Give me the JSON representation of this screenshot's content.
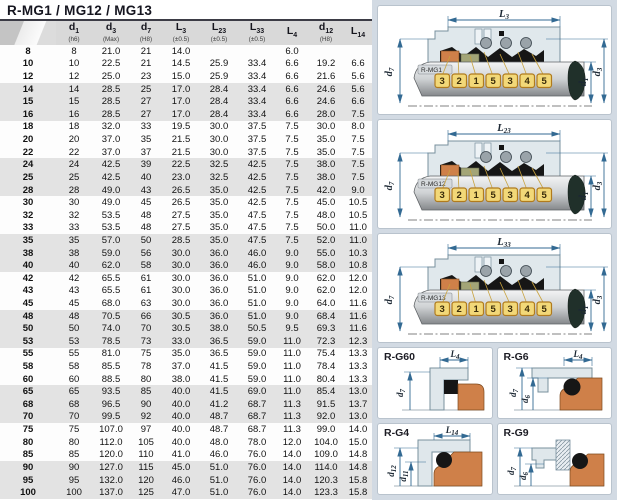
{
  "title": "R-MG1 / MG12 / MG13",
  "table": {
    "columns": [
      {
        "base": "",
        "sub_idx": "",
        "tol": ""
      },
      {
        "base": "d",
        "sub_idx": "1",
        "tol": "(h6)"
      },
      {
        "base": "d",
        "sub_idx": "3",
        "tol": "(Max)"
      },
      {
        "base": "d",
        "sub_idx": "7",
        "tol": "(H8)"
      },
      {
        "base": "L",
        "sub_idx": "3",
        "tol": "(±0.5)"
      },
      {
        "base": "L",
        "sub_idx": "23",
        "tol": "(±0.5)"
      },
      {
        "base": "L",
        "sub_idx": "33",
        "tol": "(±0.5)"
      },
      {
        "base": "L",
        "sub_idx": "4",
        "tol": ""
      },
      {
        "base": "d",
        "sub_idx": "12",
        "tol": "(H8)"
      },
      {
        "base": "L",
        "sub_idx": "14",
        "tol": ""
      }
    ],
    "rows": [
      [
        "8",
        "8",
        "21.0",
        "21",
        "14.0",
        "",
        "",
        "6.0",
        "",
        ""
      ],
      [
        "10",
        "10",
        "22.5",
        "21",
        "14.5",
        "25.9",
        "33.4",
        "6.6",
        "19.2",
        "6.6"
      ],
      [
        "12",
        "12",
        "25.0",
        "23",
        "15.0",
        "25.9",
        "33.4",
        "6.6",
        "21.6",
        "5.6"
      ],
      [
        "14",
        "14",
        "28.5",
        "25",
        "17.0",
        "28.4",
        "33.4",
        "6.6",
        "24.6",
        "5.6"
      ],
      [
        "15",
        "15",
        "28.5",
        "27",
        "17.0",
        "28.4",
        "33.4",
        "6.6",
        "24.6",
        "6.6"
      ],
      [
        "16",
        "16",
        "28.5",
        "27",
        "17.0",
        "28.4",
        "33.4",
        "6.6",
        "28.0",
        "7.5"
      ],
      [
        "18",
        "18",
        "32.0",
        "33",
        "19.5",
        "30.0",
        "37.5",
        "7.5",
        "30.0",
        "8.0"
      ],
      [
        "20",
        "20",
        "37.0",
        "35",
        "21.5",
        "30.0",
        "37.5",
        "7.5",
        "35.0",
        "7.5"
      ],
      [
        "22",
        "22",
        "37.0",
        "37",
        "21.5",
        "30.0",
        "37.5",
        "7.5",
        "35.0",
        "7.5"
      ],
      [
        "24",
        "24",
        "42.5",
        "39",
        "22.5",
        "32.5",
        "42.5",
        "7.5",
        "38.0",
        "7.5"
      ],
      [
        "25",
        "25",
        "42.5",
        "40",
        "23.0",
        "32.5",
        "42.5",
        "7.5",
        "38.0",
        "7.5"
      ],
      [
        "28",
        "28",
        "49.0",
        "43",
        "26.5",
        "35.0",
        "42.5",
        "7.5",
        "42.0",
        "9.0"
      ],
      [
        "30",
        "30",
        "49.0",
        "45",
        "26.5",
        "35.0",
        "42.5",
        "7.5",
        "45.0",
        "10.5"
      ],
      [
        "32",
        "32",
        "53.5",
        "48",
        "27.5",
        "35.0",
        "47.5",
        "7.5",
        "48.0",
        "10.5"
      ],
      [
        "33",
        "33",
        "53.5",
        "48",
        "27.5",
        "35.0",
        "47.5",
        "7.5",
        "50.0",
        "11.0"
      ],
      [
        "35",
        "35",
        "57.0",
        "50",
        "28.5",
        "35.0",
        "47.5",
        "7.5",
        "52.0",
        "11.0"
      ],
      [
        "38",
        "38",
        "59.0",
        "56",
        "30.0",
        "36.0",
        "46.0",
        "9.0",
        "55.0",
        "10.3"
      ],
      [
        "40",
        "40",
        "62.0",
        "58",
        "30.0",
        "36.0",
        "46.0",
        "9.0",
        "58.0",
        "10.8"
      ],
      [
        "42",
        "42",
        "65.5",
        "61",
        "30.0",
        "36.0",
        "51.0",
        "9.0",
        "62.0",
        "12.0"
      ],
      [
        "43",
        "43",
        "65.5",
        "61",
        "30.0",
        "36.0",
        "51.0",
        "9.0",
        "62.0",
        "12.0"
      ],
      [
        "45",
        "45",
        "68.0",
        "63",
        "30.0",
        "36.0",
        "51.0",
        "9.0",
        "64.0",
        "11.6"
      ],
      [
        "48",
        "48",
        "70.5",
        "66",
        "30.5",
        "36.0",
        "51.0",
        "9.0",
        "68.4",
        "11.6"
      ],
      [
        "50",
        "50",
        "74.0",
        "70",
        "30.5",
        "38.0",
        "50.5",
        "9.5",
        "69.3",
        "11.6"
      ],
      [
        "53",
        "53",
        "78.5",
        "73",
        "33.0",
        "36.5",
        "59.0",
        "11.0",
        "72.3",
        "12.3"
      ],
      [
        "55",
        "55",
        "81.0",
        "75",
        "35.0",
        "36.5",
        "59.0",
        "11.0",
        "75.4",
        "13.3"
      ],
      [
        "58",
        "58",
        "85.5",
        "78",
        "37.0",
        "41.5",
        "59.0",
        "11.0",
        "78.4",
        "13.3"
      ],
      [
        "60",
        "60",
        "88.5",
        "80",
        "38.0",
        "41.5",
        "59.0",
        "11.0",
        "80.4",
        "13.3"
      ],
      [
        "65",
        "65",
        "93.5",
        "85",
        "40.0",
        "41.5",
        "69.0",
        "11.0",
        "85.4",
        "13.0"
      ],
      [
        "68",
        "68",
        "96.5",
        "90",
        "40.0",
        "41.2",
        "68.7",
        "11.3",
        "91.5",
        "13.7"
      ],
      [
        "70",
        "70",
        "99.5",
        "92",
        "40.0",
        "48.7",
        "68.7",
        "11.3",
        "92.0",
        "13.0"
      ],
      [
        "75",
        "75",
        "107.0",
        "97",
        "40.0",
        "48.7",
        "68.7",
        "11.3",
        "99.0",
        "14.0"
      ],
      [
        "80",
        "80",
        "112.0",
        "105",
        "40.0",
        "48.0",
        "78.0",
        "12.0",
        "104.0",
        "15.0"
      ],
      [
        "85",
        "85",
        "120.0",
        "110",
        "41.0",
        "46.0",
        "76.0",
        "14.0",
        "109.0",
        "14.8"
      ],
      [
        "90",
        "90",
        "127.0",
        "115",
        "45.0",
        "51.0",
        "76.0",
        "14.0",
        "114.0",
        "14.8"
      ],
      [
        "95",
        "95",
        "132.0",
        "120",
        "46.0",
        "51.0",
        "76.0",
        "14.0",
        "120.3",
        "15.8"
      ],
      [
        "100",
        "100",
        "137.0",
        "125",
        "47.0",
        "51.0",
        "76.0",
        "14.0",
        "123.3",
        "15.8"
      ]
    ]
  },
  "diagrams": [
    {
      "label": "R-MG1",
      "top_dim": {
        "base": "L",
        "sub": "3"
      },
      "left_dim": {
        "base": "d",
        "sub": "7"
      },
      "right_dims": [
        {
          "base": "d",
          "sub": "1"
        },
        {
          "base": "d",
          "sub": "3"
        }
      ],
      "part_numbers": [
        "3",
        "2",
        "1",
        "5",
        "3",
        "4",
        "5"
      ]
    },
    {
      "label": "R-MG12",
      "top_dim": {
        "base": "L",
        "sub": "23"
      },
      "left_dim": {
        "base": "d",
        "sub": "7"
      },
      "right_dims": [
        {
          "base": "d",
          "sub": "1"
        },
        {
          "base": "d",
          "sub": "3"
        }
      ],
      "part_numbers": [
        "3",
        "2",
        "1",
        "5",
        "3",
        "4",
        "5"
      ]
    },
    {
      "label": "R-MG13",
      "top_dim": {
        "base": "L",
        "sub": "33"
      },
      "left_dim": {
        "base": "d",
        "sub": "7"
      },
      "right_dims": [
        {
          "base": "d",
          "sub": "1"
        },
        {
          "base": "d",
          "sub": "3"
        }
      ],
      "part_numbers": [
        "3",
        "2",
        "1",
        "5",
        "3",
        "4",
        "5"
      ]
    }
  ],
  "small_diagrams": [
    {
      "label": "R-G60",
      "top_dim": {
        "base": "L",
        "sub": "4"
      },
      "dims": [
        {
          "base": "d",
          "sub": "7"
        }
      ]
    },
    {
      "label": "R-G6",
      "top_dim": {
        "base": "L",
        "sub": "4"
      },
      "dims": [
        {
          "base": "d",
          "sub": "7"
        },
        {
          "base": "d",
          "sub": "6"
        }
      ]
    },
    {
      "label": "R-G4",
      "top_dim": {
        "base": "L",
        "sub": "14"
      },
      "dims": [
        {
          "base": "d",
          "sub": "12"
        },
        {
          "base": "d",
          "sub": "11"
        }
      ]
    },
    {
      "label": "R-G9",
      "top_dim": null,
      "dims": [
        {
          "base": "d",
          "sub": "7"
        },
        {
          "base": "d",
          "sub": "6"
        }
      ]
    }
  ],
  "colors": {
    "dim_blue": "#336a93",
    "panel_bg": "#d2dae3",
    "row_band": "#e3e3e3",
    "part_orange": "#cf8049",
    "part_olive": "#a3a577",
    "callout_yellow": "#f2d878",
    "header_gray": "#d9d9d9"
  }
}
